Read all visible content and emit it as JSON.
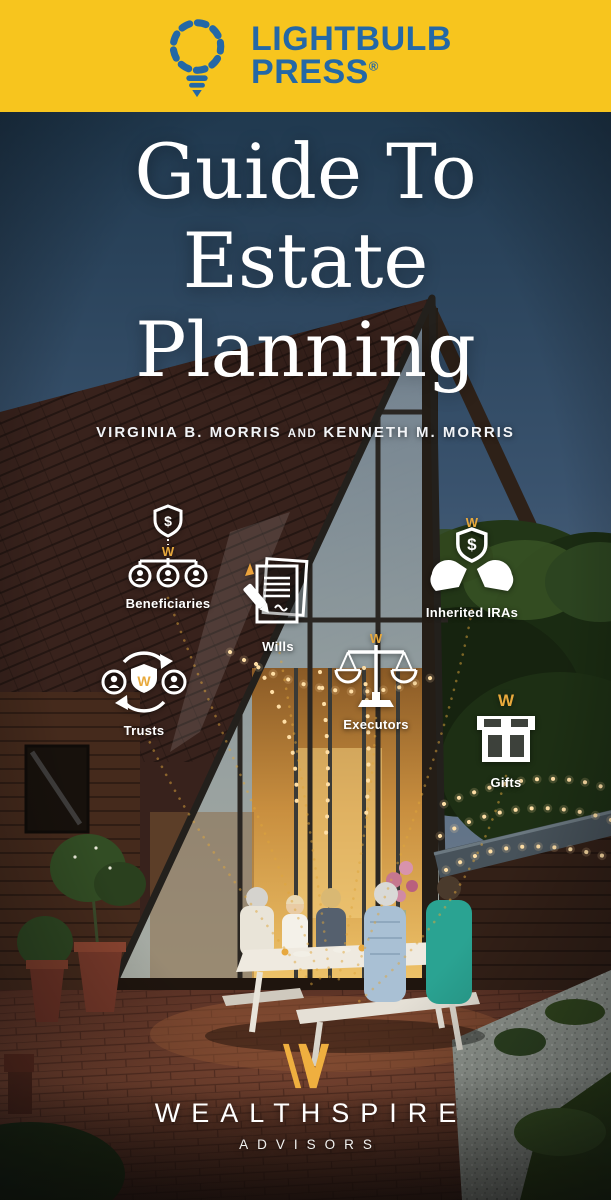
{
  "cover": {
    "publisher": {
      "name_line1": "LIGHTBULB",
      "name_line2": "PRESS",
      "registered_mark": "®"
    },
    "title": {
      "line1": "Guide To",
      "line2": "Estate",
      "line3": "Planning"
    },
    "byline": {
      "author_1": "VIRGINIA B. MORRIS",
      "conjunction": "AND",
      "author_2": "KENNETH M. MORRIS"
    },
    "topics": {
      "beneficiaries": {
        "label": "Beneficiaries"
      },
      "wills": {
        "label": "Wills"
      },
      "trusts": {
        "label": "Trusts"
      },
      "executors": {
        "label": "Executors"
      },
      "inherited_iras": {
        "label": "Inherited IRAs"
      },
      "gifts": {
        "label": "Gifts"
      }
    },
    "brand": {
      "name": "WEALTHSPIRE",
      "subtitle": "ADVISORS"
    },
    "glyphs": {
      "dollar": "$",
      "monogram": "W"
    },
    "colors": {
      "band_yellow": "#F7C51E",
      "logo_blue": "#2468A6",
      "accent_gold": "#E8A93C",
      "text_white": "#FFFFFF"
    }
  }
}
